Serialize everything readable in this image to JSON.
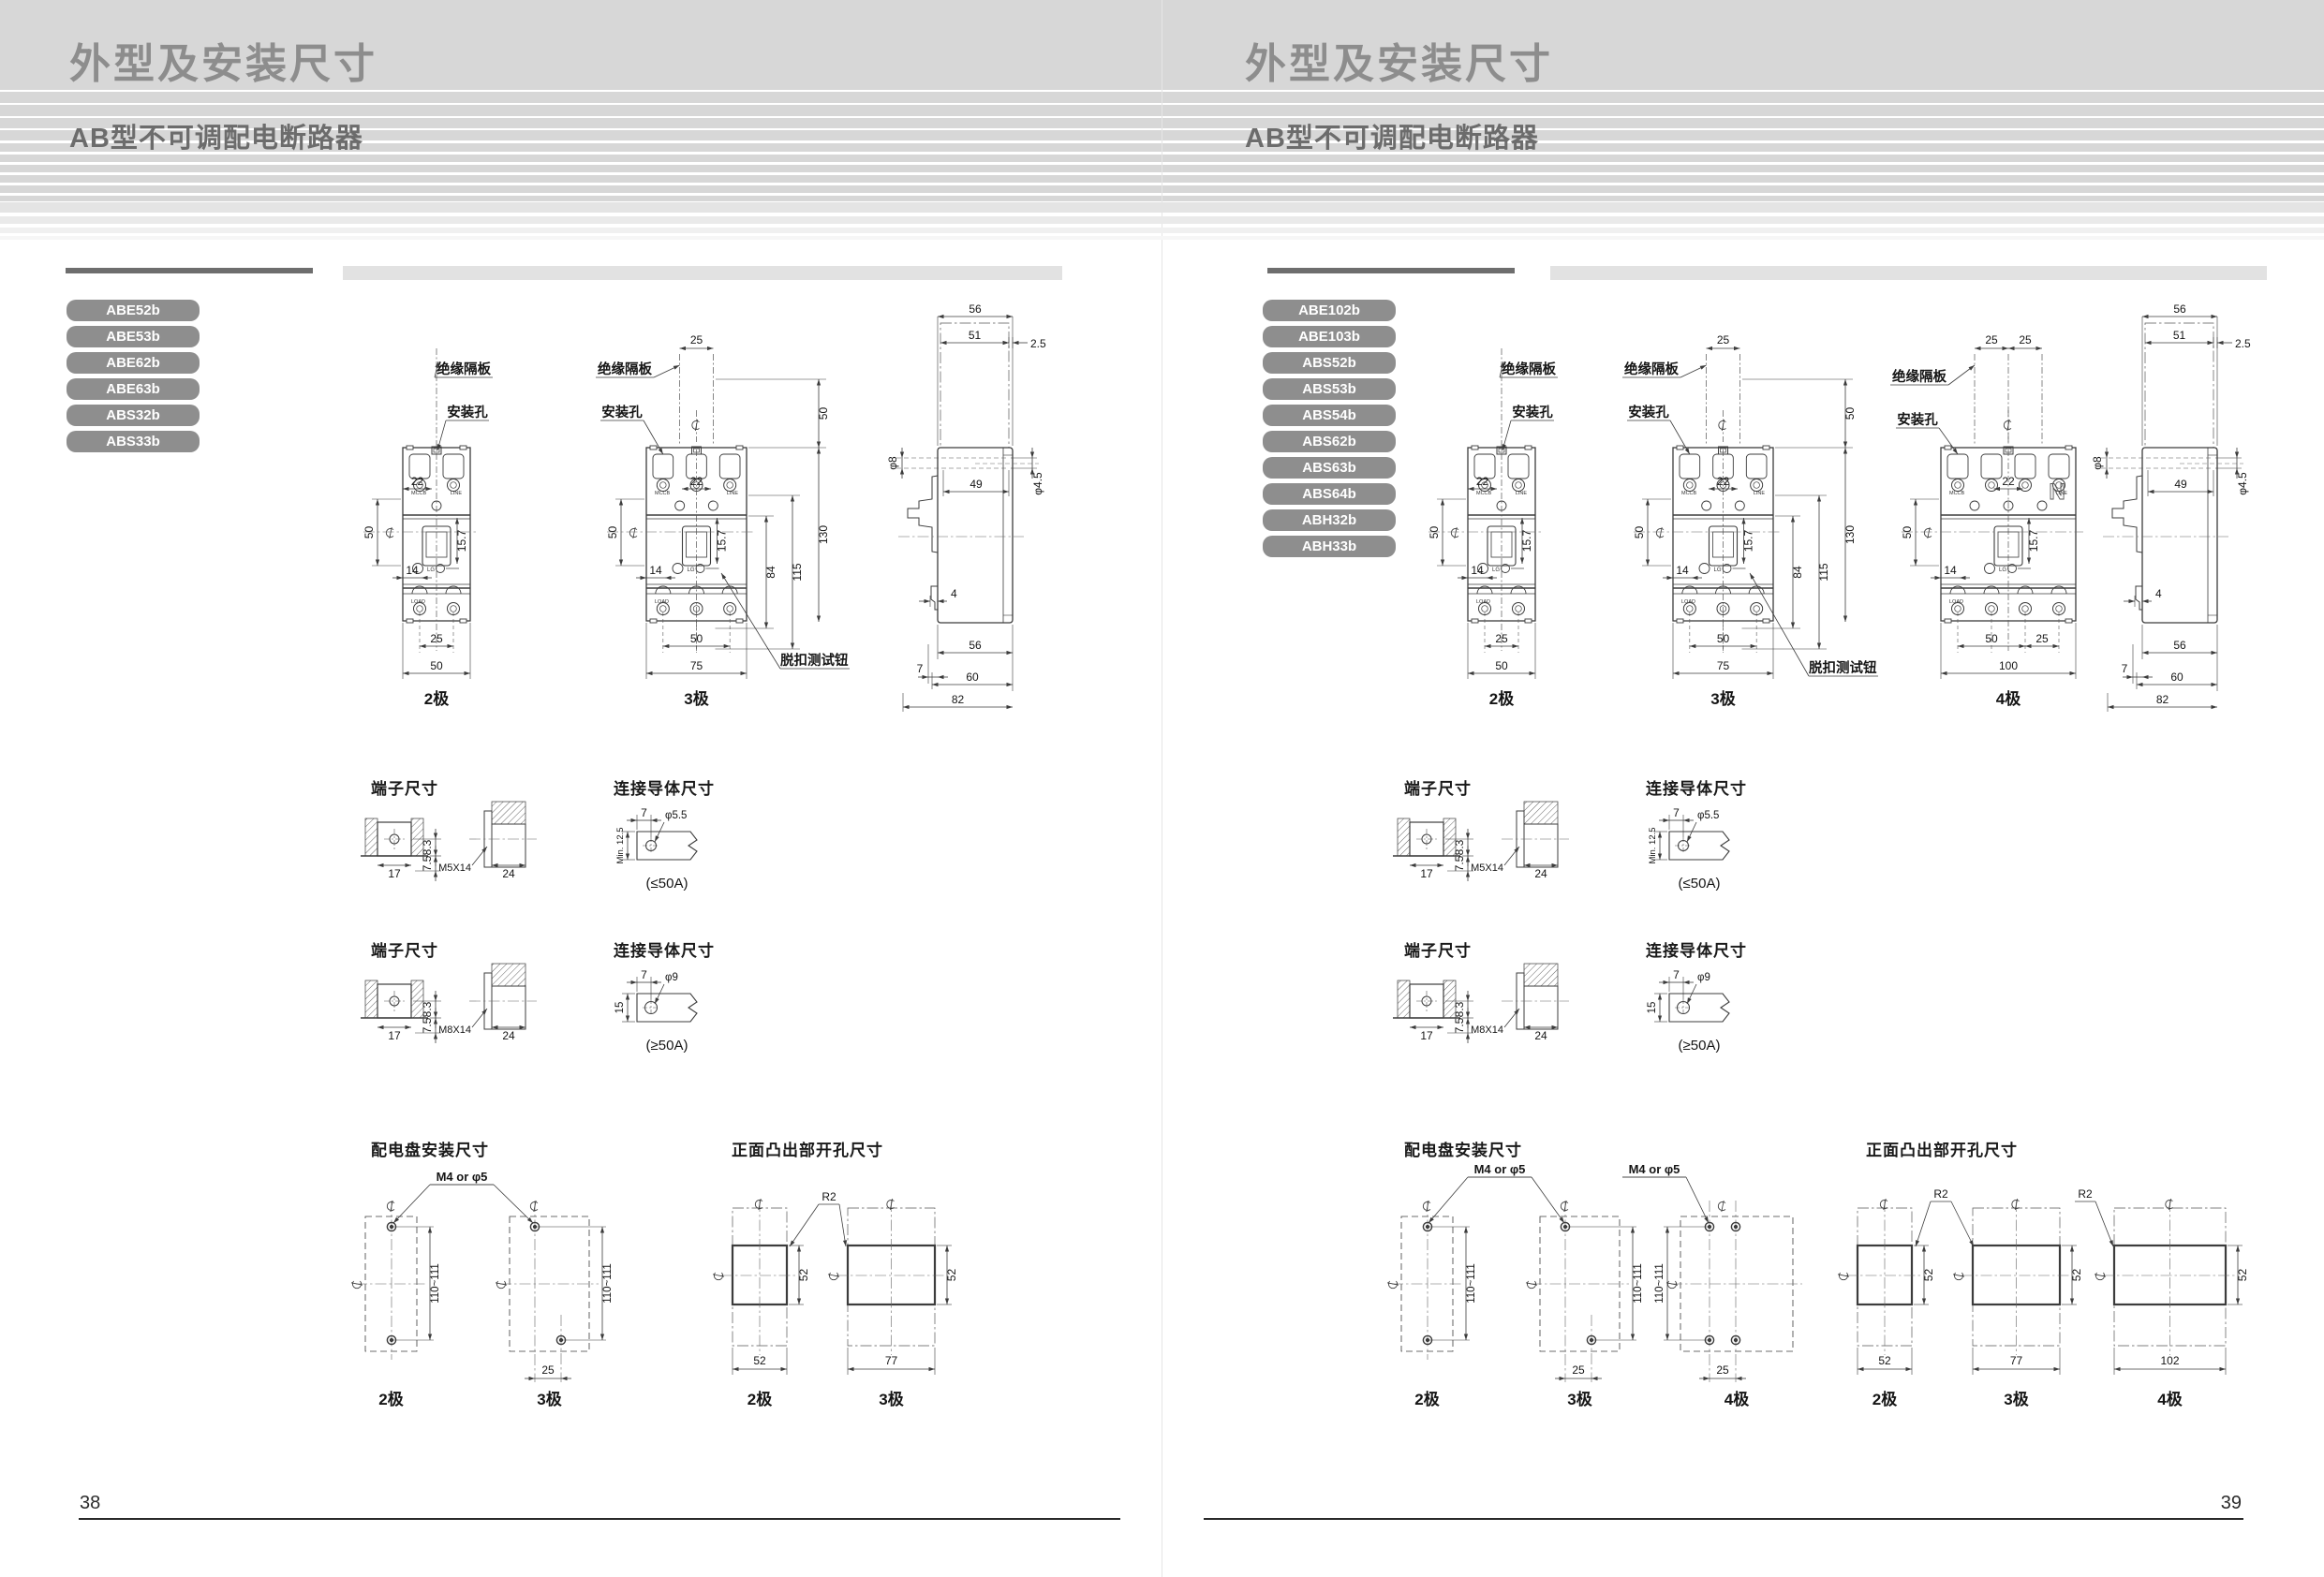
{
  "page_left": {
    "page_number": "38",
    "header": {
      "title": "外型及安装尺寸",
      "subtitle": "AB型不可调配电断路器"
    },
    "models": [
      "ABE52b",
      "ABE53b",
      "ABE62b",
      "ABE63b",
      "ABS32b",
      "ABS33b"
    ]
  },
  "page_right": {
    "page_number": "39",
    "header": {
      "title": "外型及安装尺寸",
      "subtitle": "AB型不可调配电断路器"
    },
    "models": [
      "ABE102b",
      "ABE103b",
      "ABS52b",
      "ABS53b",
      "ABS54b",
      "ABS62b",
      "ABS63b",
      "ABS64b",
      "ABH32b",
      "ABH33b"
    ]
  },
  "shared": {
    "labels": {
      "insulation": "绝缘隔板",
      "mount_hole": "安装孔",
      "trip_test": "脱扣测试钮",
      "pole2": "2极",
      "pole3": "3极",
      "pole4": "4极",
      "m4": "M4 or φ5",
      "r2": "R2",
      "mccb": "MCCB",
      "line": "LINE",
      "load": "LOAD",
      "lg": "LG",
      "n": "N"
    },
    "front": {
      "p25": "25",
      "p25b": "25",
      "d22": "22",
      "d50": "50",
      "d14": "14",
      "d157": "15.7",
      "b25": "25",
      "b50": "50",
      "b50b": "50",
      "b25b": "25",
      "w50": "50",
      "w75": "75",
      "w100": "100",
      "r50": "50",
      "r84": "84",
      "r115": "115",
      "r130": "130"
    },
    "side": {
      "t56": "56",
      "t51": "51",
      "t25": "2.5",
      "phi8": "φ8",
      "d49": "49",
      "phi45": "φ4.5",
      "d4": "4",
      "b56": "56",
      "b7": "7",
      "b60": "60",
      "b82": "82"
    },
    "term": {
      "title": "端子尺寸",
      "w17": "17",
      "h83": "8.3",
      "h75": "7.5",
      "m5": "M5X14",
      "m8": "M8X14",
      "d24": "24"
    },
    "cond": {
      "title": "连接导体尺寸",
      "d7": "7",
      "phi55": "φ5.5",
      "phi9": "φ9",
      "min125": "Min. 12.5",
      "d15": "15",
      "le": "(≤50A)",
      "ge": "(≥50A)"
    },
    "mountsec": {
      "title": "配电盘安装尺寸",
      "v": "110~111",
      "d25": "25"
    },
    "cutsec": {
      "title": "正面凸出部开孔尺寸",
      "h52": "52",
      "w52": "52",
      "w77": "77",
      "w102": "102"
    }
  }
}
